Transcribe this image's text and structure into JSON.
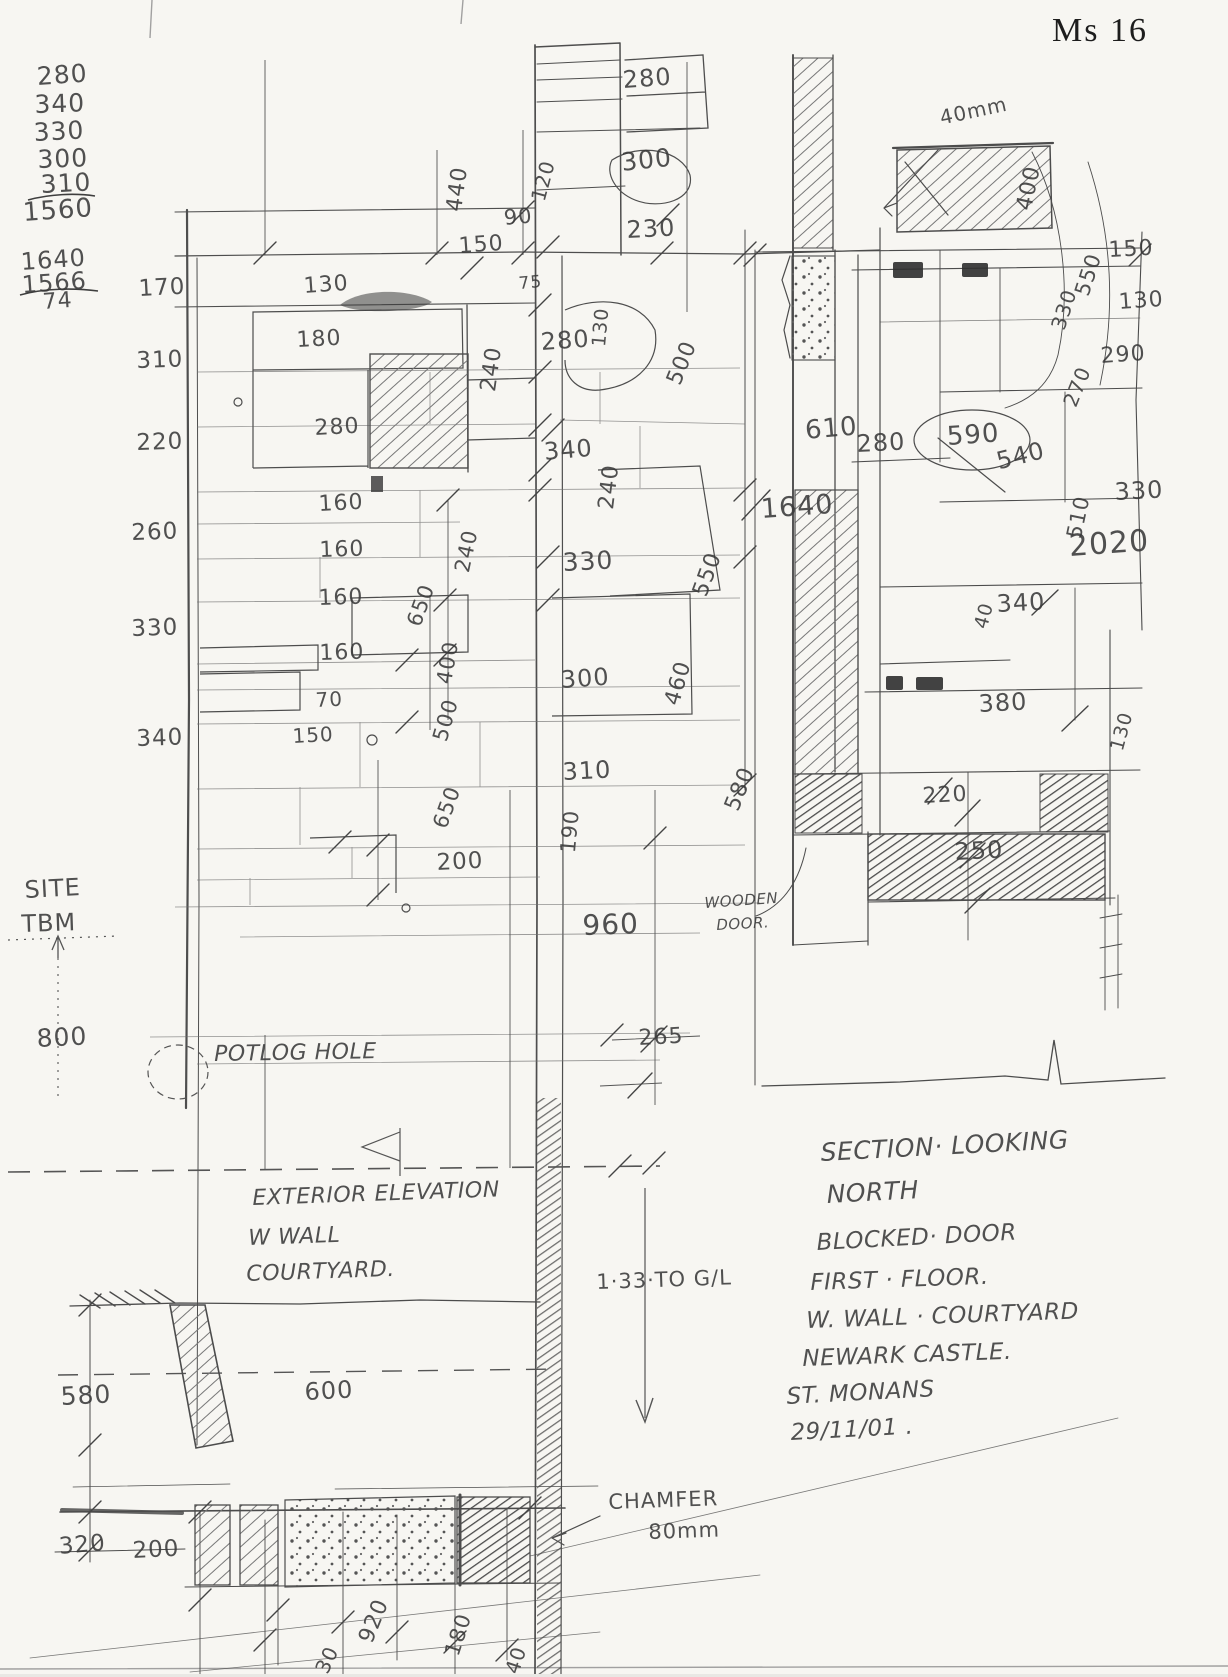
{
  "page_title": "Ms 16",
  "colors": {
    "paper": "#f7f6f2",
    "pencil": "#4a4a4a",
    "pencil_light": "#8a8a8a"
  },
  "annotations": {
    "calc_column": [
      {
        "t": "280",
        "x": 36,
        "y": 64,
        "s": 25,
        "r": -4
      },
      {
        "t": "340",
        "x": 34,
        "y": 92,
        "s": 25,
        "r": -2
      },
      {
        "t": "330",
        "x": 33,
        "y": 120,
        "s": 25,
        "r": -3
      },
      {
        "t": "300",
        "x": 37,
        "y": 147,
        "s": 25,
        "r": -2
      },
      {
        "t": "310",
        "x": 40,
        "y": 172,
        "s": 25,
        "r": -3
      },
      {
        "t": "1560",
        "x": 22,
        "y": 200,
        "s": 26,
        "r": -4
      },
      {
        "t": "1640",
        "x": 20,
        "y": 250,
        "s": 24,
        "r": -4
      },
      {
        "t": "1566",
        "x": 21,
        "y": 273,
        "s": 24,
        "r": -4
      },
      {
        "t": "74",
        "x": 42,
        "y": 292,
        "s": 22,
        "r": -4
      }
    ],
    "left_dims": [
      {
        "t": "170",
        "x": 138,
        "y": 278,
        "s": 23,
        "r": -3
      },
      {
        "t": "310",
        "x": 136,
        "y": 350,
        "s": 23,
        "r": -2
      },
      {
        "t": "220",
        "x": 136,
        "y": 432,
        "s": 23,
        "r": -2
      },
      {
        "t": "260",
        "x": 131,
        "y": 522,
        "s": 23,
        "r": -2
      },
      {
        "t": "330",
        "x": 131,
        "y": 618,
        "s": 23,
        "r": -2
      },
      {
        "t": "340",
        "x": 136,
        "y": 728,
        "s": 23,
        "r": -2
      }
    ],
    "top_dims": [
      {
        "t": "440",
        "x": 444,
        "y": 210,
        "s": 22,
        "r": -82
      },
      {
        "t": "120",
        "x": 528,
        "y": 198,
        "s": 20,
        "r": -75
      },
      {
        "t": "90",
        "x": 503,
        "y": 208,
        "s": 21,
        "r": -5
      },
      {
        "t": "150",
        "x": 458,
        "y": 236,
        "s": 22,
        "r": -4
      },
      {
        "t": "280",
        "x": 622,
        "y": 68,
        "s": 24,
        "r": -4
      },
      {
        "t": "300",
        "x": 620,
        "y": 150,
        "s": 25,
        "r": -6
      },
      {
        "t": "230",
        "x": 626,
        "y": 218,
        "s": 24,
        "r": -3
      },
      {
        "t": "75",
        "x": 518,
        "y": 276,
        "s": 17,
        "r": -5
      },
      {
        "t": "40mm",
        "x": 938,
        "y": 108,
        "s": 20,
        "r": -12
      }
    ],
    "elevation_dims": [
      {
        "t": "130",
        "x": 303,
        "y": 276,
        "s": 22,
        "r": -4
      },
      {
        "t": "180",
        "x": 296,
        "y": 330,
        "s": 22,
        "r": -3
      },
      {
        "t": "280",
        "x": 314,
        "y": 418,
        "s": 22,
        "r": -3
      },
      {
        "t": "240",
        "x": 478,
        "y": 390,
        "s": 22,
        "r": -82
      },
      {
        "t": "280",
        "x": 540,
        "y": 330,
        "s": 24,
        "r": -4
      },
      {
        "t": "130",
        "x": 590,
        "y": 346,
        "s": 19,
        "r": -85
      },
      {
        "t": "500",
        "x": 664,
        "y": 380,
        "s": 22,
        "r": -68
      },
      {
        "t": "340",
        "x": 543,
        "y": 440,
        "s": 24,
        "r": -5
      },
      {
        "t": "240",
        "x": 596,
        "y": 508,
        "s": 22,
        "r": -83
      },
      {
        "t": "330",
        "x": 562,
        "y": 550,
        "s": 25,
        "r": -3
      },
      {
        "t": "550",
        "x": 690,
        "y": 592,
        "s": 22,
        "r": -70
      },
      {
        "t": "160",
        "x": 318,
        "y": 494,
        "s": 22,
        "r": -3
      },
      {
        "t": "160",
        "x": 319,
        "y": 540,
        "s": 22,
        "r": -2
      },
      {
        "t": "160",
        "x": 318,
        "y": 588,
        "s": 22,
        "r": -2
      },
      {
        "t": "160",
        "x": 319,
        "y": 643,
        "s": 22,
        "r": -2
      },
      {
        "t": "70",
        "x": 315,
        "y": 690,
        "s": 20,
        "r": -3
      },
      {
        "t": "150",
        "x": 292,
        "y": 726,
        "s": 20,
        "r": -3
      },
      {
        "t": "240",
        "x": 452,
        "y": 570,
        "s": 21,
        "r": -78
      },
      {
        "t": "650",
        "x": 404,
        "y": 622,
        "s": 21,
        "r": -70
      },
      {
        "t": "400",
        "x": 434,
        "y": 682,
        "s": 21,
        "r": -80
      },
      {
        "t": "500",
        "x": 430,
        "y": 738,
        "s": 21,
        "r": -74
      },
      {
        "t": "300",
        "x": 560,
        "y": 668,
        "s": 24,
        "r": -4
      },
      {
        "t": "460",
        "x": 662,
        "y": 702,
        "s": 22,
        "r": -74
      },
      {
        "t": "310",
        "x": 562,
        "y": 760,
        "s": 24,
        "r": -3
      },
      {
        "t": "580",
        "x": 722,
        "y": 806,
        "s": 22,
        "r": -68
      },
      {
        "t": "650",
        "x": 430,
        "y": 824,
        "s": 21,
        "r": -70
      },
      {
        "t": "200",
        "x": 436,
        "y": 852,
        "s": 23,
        "r": -3
      },
      {
        "t": "190",
        "x": 558,
        "y": 852,
        "s": 21,
        "r": -85
      },
      {
        "t": "960",
        "x": 582,
        "y": 912,
        "s": 28,
        "r": -2
      },
      {
        "t": "265",
        "x": 638,
        "y": 1028,
        "s": 22,
        "r": -3
      },
      {
        "t": "800",
        "x": 36,
        "y": 1026,
        "s": 25,
        "r": -3
      },
      {
        "t": "1·33·TO G/L",
        "x": 596,
        "y": 1272,
        "s": 21,
        "r": -2
      }
    ],
    "section_dims": [
      {
        "t": "400",
        "x": 1014,
        "y": 208,
        "s": 22,
        "r": -78
      },
      {
        "t": "550",
        "x": 1072,
        "y": 292,
        "s": 21,
        "r": -72
      },
      {
        "t": "150",
        "x": 1108,
        "y": 240,
        "s": 22,
        "r": -3
      },
      {
        "t": "330",
        "x": 1048,
        "y": 326,
        "s": 20,
        "r": -72
      },
      {
        "t": "130",
        "x": 1118,
        "y": 292,
        "s": 22,
        "r": -4
      },
      {
        "t": "290",
        "x": 1100,
        "y": 346,
        "s": 22,
        "r": -4
      },
      {
        "t": "270",
        "x": 1060,
        "y": 402,
        "s": 20,
        "r": -68
      },
      {
        "t": "610",
        "x": 804,
        "y": 418,
        "s": 26,
        "r": -5
      },
      {
        "t": "280",
        "x": 856,
        "y": 432,
        "s": 24,
        "r": -3
      },
      {
        "t": "590",
        "x": 946,
        "y": 424,
        "s": 26,
        "r": -4
      },
      {
        "t": "540",
        "x": 994,
        "y": 450,
        "s": 24,
        "r": -14
      },
      {
        "t": "1640",
        "x": 760,
        "y": 496,
        "s": 27,
        "r": -4
      },
      {
        "t": "510",
        "x": 1064,
        "y": 536,
        "s": 21,
        "r": -78
      },
      {
        "t": "330",
        "x": 1114,
        "y": 480,
        "s": 24,
        "r": -3
      },
      {
        "t": "2020",
        "x": 1068,
        "y": 532,
        "s": 30,
        "r": -4
      },
      {
        "t": "40",
        "x": 972,
        "y": 626,
        "s": 19,
        "r": -75
      },
      {
        "t": "340",
        "x": 996,
        "y": 592,
        "s": 24,
        "r": -3
      },
      {
        "t": "380",
        "x": 978,
        "y": 692,
        "s": 24,
        "r": -3
      },
      {
        "t": "130",
        "x": 1108,
        "y": 748,
        "s": 19,
        "r": -75
      },
      {
        "t": "220",
        "x": 922,
        "y": 786,
        "s": 22,
        "r": -3
      },
      {
        "t": "250",
        "x": 954,
        "y": 840,
        "s": 24,
        "r": -3
      }
    ],
    "bottom_dims": [
      {
        "t": "580",
        "x": 60,
        "y": 1384,
        "s": 25,
        "r": -3
      },
      {
        "t": "600",
        "x": 304,
        "y": 1380,
        "s": 24,
        "r": -3
      },
      {
        "t": "320",
        "x": 58,
        "y": 1536,
        "s": 23,
        "r": -5
      },
      {
        "t": "200",
        "x": 132,
        "y": 1540,
        "s": 23,
        "r": -3
      },
      {
        "t": "920",
        "x": 356,
        "y": 1638,
        "s": 22,
        "r": -68
      },
      {
        "t": "180",
        "x": 442,
        "y": 1652,
        "s": 21,
        "r": -72
      },
      {
        "t": "30",
        "x": 312,
        "y": 1668,
        "s": 20,
        "r": -65
      },
      {
        "t": "40",
        "x": 502,
        "y": 1670,
        "s": 20,
        "r": -72
      },
      {
        "t": "CHAMFER",
        "x": 608,
        "y": 1492,
        "s": 21,
        "r": -2
      },
      {
        "t": "80mm",
        "x": 648,
        "y": 1522,
        "s": 21,
        "r": -2
      }
    ],
    "notes": [
      {
        "t": "SITE",
        "x": 24,
        "y": 878,
        "s": 24,
        "r": -3
      },
      {
        "t": "TBM",
        "x": 21,
        "y": 912,
        "s": 24,
        "r": -2
      },
      {
        "t": "POTLOG HOLE",
        "x": 214,
        "y": 1044,
        "s": 22,
        "r": -1,
        "c": "note"
      },
      {
        "t": "WOODEN",
        "x": 704,
        "y": 896,
        "s": 15,
        "r": -4,
        "c": "note"
      },
      {
        "t": "DOOR.",
        "x": 716,
        "y": 918,
        "s": 15,
        "r": -3,
        "c": "note"
      },
      {
        "t": "EXTERIOR  ELEVATION",
        "x": 252,
        "y": 1188,
        "s": 22,
        "r": -2,
        "c": "note"
      },
      {
        "t": "W WALL",
        "x": 248,
        "y": 1228,
        "s": 22,
        "r": -2,
        "c": "note"
      },
      {
        "t": "COURTYARD.",
        "x": 246,
        "y": 1264,
        "s": 22,
        "r": -2,
        "c": "note"
      },
      {
        "t": "SECTION·  LOOKING",
        "x": 820,
        "y": 1140,
        "s": 25,
        "r": -3,
        "c": "note"
      },
      {
        "t": "NORTH",
        "x": 826,
        "y": 1182,
        "s": 25,
        "r": -3,
        "c": "note"
      },
      {
        "t": "BLOCKED·  DOOR",
        "x": 816,
        "y": 1232,
        "s": 23,
        "r": -3,
        "c": "note"
      },
      {
        "t": "FIRST · FLOOR.",
        "x": 810,
        "y": 1272,
        "s": 23,
        "r": -2,
        "c": "note"
      },
      {
        "t": "W. WALL · COURTYARD",
        "x": 806,
        "y": 1310,
        "s": 23,
        "r": -2,
        "c": "note"
      },
      {
        "t": "NEWARK CASTLE.",
        "x": 802,
        "y": 1348,
        "s": 23,
        "r": -2,
        "c": "note"
      },
      {
        "t": "ST. MONANS",
        "x": 786,
        "y": 1386,
        "s": 23,
        "r": -3,
        "c": "note"
      },
      {
        "t": "29/11/01 .",
        "x": 790,
        "y": 1422,
        "s": 23,
        "r": -3,
        "c": "note"
      }
    ]
  }
}
